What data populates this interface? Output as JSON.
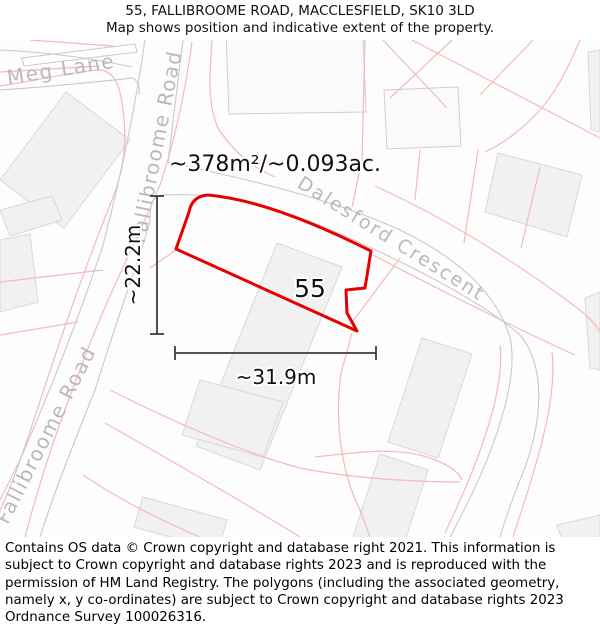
{
  "header": {
    "title": "55, FALLIBROOME ROAD, MACCLESFIELD, SK10 3LD",
    "subtitle": "Map shows position and indicative extent of the property."
  },
  "map": {
    "area_label": "~378m²/~0.093ac.",
    "plot_number": "55",
    "width_dimension": "~31.9m",
    "height_dimension": "~22.2m",
    "streets": {
      "meg_lane": "Meg Lane",
      "fallibroome_road_upper": "Fallibroome Road",
      "fallibroome_road_lower": "Fallibroome Road",
      "dalesford_crescent": "Dalesford Crescent"
    },
    "colors": {
      "property_outline": "#e60000",
      "parcel_line": "#f5b9b9",
      "road_line": "#c9c9c9",
      "street_label": "#b9b9b9",
      "dimension_line": "#3c3c3c"
    }
  },
  "footer": {
    "copyright": "Contains OS data © Crown copyright and database right 2021. This information is subject to Crown copyright and database rights 2023 and is reproduced with the permission of HM Land Registry. The polygons (including the associated geometry, namely x, y co-ordinates) are subject to Crown copyright and database rights 2023 Ordnance Survey 100026316."
  }
}
